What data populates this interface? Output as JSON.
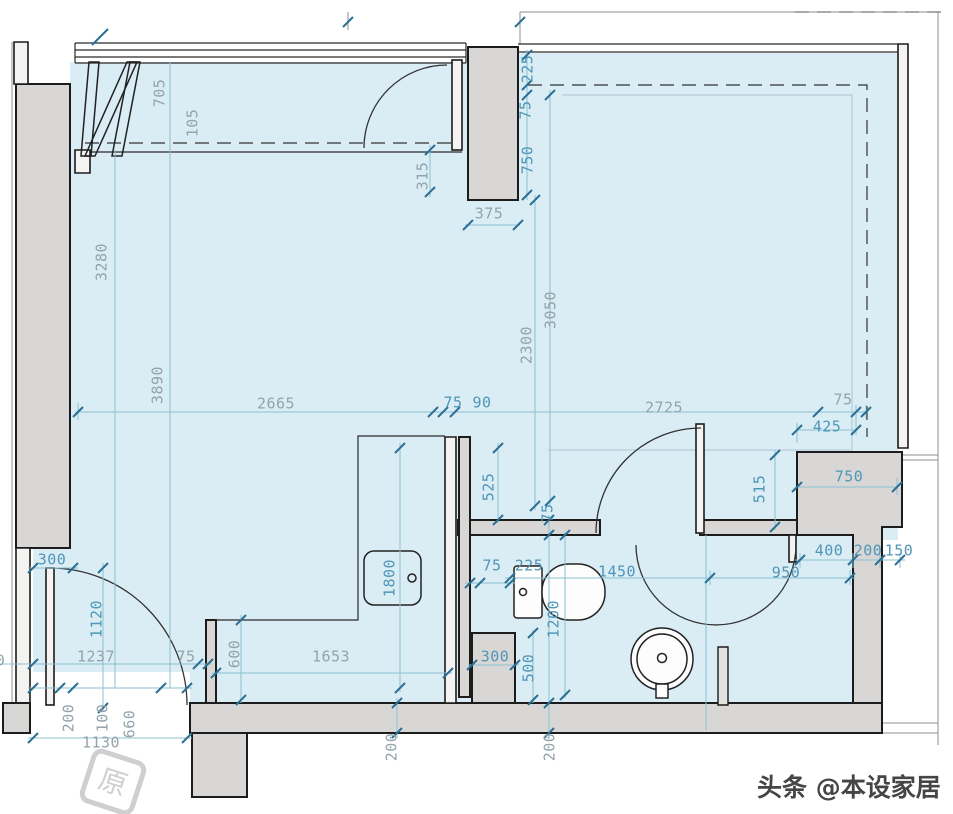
{
  "colors": {
    "room-fill": "#daecf4",
    "wall-fill": "#d9d7d5",
    "wall-stroke": "#1c1c1c",
    "dim-teal": "#4f96b8",
    "dim-gray": "#93a3ab",
    "tick": "#2a6f94",
    "dim-line": "#8cc0d2"
  },
  "dimensions": [
    {
      "label": "705",
      "x": 160,
      "y": 93,
      "rot": -90,
      "tone": "gray"
    },
    {
      "label": "105",
      "x": 193,
      "y": 123,
      "rot": -90,
      "tone": "gray"
    },
    {
      "label": "315",
      "x": 423,
      "y": 176,
      "rot": -90,
      "tone": "gray"
    },
    {
      "label": "375",
      "x": 489,
      "y": 214,
      "rot": 0,
      "tone": "gray"
    },
    {
      "label": "225",
      "x": 528,
      "y": 69,
      "rot": -90,
      "tone": "teal"
    },
    {
      "label": "75",
      "x": 526,
      "y": 110,
      "rot": -90,
      "tone": "teal"
    },
    {
      "label": "750",
      "x": 528,
      "y": 160,
      "rot": -90,
      "tone": "teal"
    },
    {
      "label": "3280",
      "x": 102,
      "y": 262,
      "rot": -90,
      "tone": "gray"
    },
    {
      "label": "3890",
      "x": 158,
      "y": 385,
      "rot": -90,
      "tone": "gray"
    },
    {
      "label": "2300",
      "x": 527,
      "y": 345,
      "rot": -90,
      "tone": "gray"
    },
    {
      "label": "3050",
      "x": 551,
      "y": 310,
      "rot": -90,
      "tone": "gray"
    },
    {
      "label": "2665",
      "x": 276,
      "y": 404,
      "rot": 0,
      "tone": "gray"
    },
    {
      "label": "75",
      "x": 453,
      "y": 403,
      "rot": 0,
      "tone": "teal"
    },
    {
      "label": "90",
      "x": 482,
      "y": 403,
      "rot": 0,
      "tone": "teal"
    },
    {
      "label": "2725",
      "x": 664,
      "y": 408,
      "rot": 0,
      "tone": "gray"
    },
    {
      "label": "75",
      "x": 843,
      "y": 400,
      "rot": 0,
      "tone": "gray"
    },
    {
      "label": "425",
      "x": 827,
      "y": 427,
      "rot": 0,
      "tone": "teal"
    },
    {
      "label": "750",
      "x": 849,
      "y": 477,
      "rot": 0,
      "tone": "teal"
    },
    {
      "label": "515",
      "x": 760,
      "y": 489,
      "rot": -90,
      "tone": "teal"
    },
    {
      "label": "525",
      "x": 489,
      "y": 487,
      "rot": -90,
      "tone": "teal"
    },
    {
      "label": "75",
      "x": 548,
      "y": 513,
      "rot": -90,
      "tone": "teal"
    },
    {
      "label": "400",
      "x": 829,
      "y": 551,
      "rot": 0,
      "tone": "teal"
    },
    {
      "label": "200",
      "x": 868,
      "y": 551,
      "rot": 0,
      "tone": "teal"
    },
    {
      "label": "150",
      "x": 899,
      "y": 551,
      "rot": 0,
      "tone": "teal"
    },
    {
      "label": "950",
      "x": 786,
      "y": 573,
      "rot": 0,
      "tone": "teal"
    },
    {
      "label": "1450",
      "x": 617,
      "y": 572,
      "rot": 0,
      "tone": "teal"
    },
    {
      "label": "75",
      "x": 492,
      "y": 566,
      "rot": 0,
      "tone": "teal"
    },
    {
      "label": "225",
      "x": 529,
      "y": 566,
      "rot": 0,
      "tone": "teal"
    },
    {
      "label": "1200",
      "x": 554,
      "y": 619,
      "rot": -90,
      "tone": "teal"
    },
    {
      "label": "1800",
      "x": 390,
      "y": 578,
      "rot": -90,
      "tone": "teal"
    },
    {
      "label": "300",
      "x": 495,
      "y": 657,
      "rot": 0,
      "tone": "teal"
    },
    {
      "label": "500",
      "x": 529,
      "y": 668,
      "rot": -90,
      "tone": "teal"
    },
    {
      "label": "300",
      "x": 52,
      "y": 560,
      "rot": 0,
      "tone": "teal"
    },
    {
      "label": "1120",
      "x": 97,
      "y": 619,
      "rot": -90,
      "tone": "teal"
    },
    {
      "label": "1237",
      "x": 96,
      "y": 657,
      "rot": 0,
      "tone": "gray"
    },
    {
      "label": "75",
      "x": 186,
      "y": 657,
      "rot": 0,
      "tone": "gray"
    },
    {
      "label": "600",
      "x": 235,
      "y": 654,
      "rot": -90,
      "tone": "gray"
    },
    {
      "label": "1653",
      "x": 331,
      "y": 657,
      "rot": 0,
      "tone": "gray"
    },
    {
      "label": "200",
      "x": 69,
      "y": 718,
      "rot": -90,
      "tone": "gray"
    },
    {
      "label": "100",
      "x": 103,
      "y": 718,
      "rot": -90,
      "tone": "gray"
    },
    {
      "label": "660",
      "x": 130,
      "y": 724,
      "rot": -90,
      "tone": "gray"
    },
    {
      "label": "1130",
      "x": 101,
      "y": 743,
      "rot": 0,
      "tone": "gray"
    },
    {
      "label": "200",
      "x": 392,
      "y": 747,
      "rot": -90,
      "tone": "gray"
    },
    {
      "label": "200",
      "x": 550,
      "y": 747,
      "rot": -90,
      "tone": "gray"
    },
    {
      "label": "200",
      "x": -9,
      "y": 661,
      "rot": 0,
      "tone": "gray"
    }
  ],
  "watermarks": {
    "byline": "头条 @本设家居",
    "logo_glyph": "原"
  }
}
